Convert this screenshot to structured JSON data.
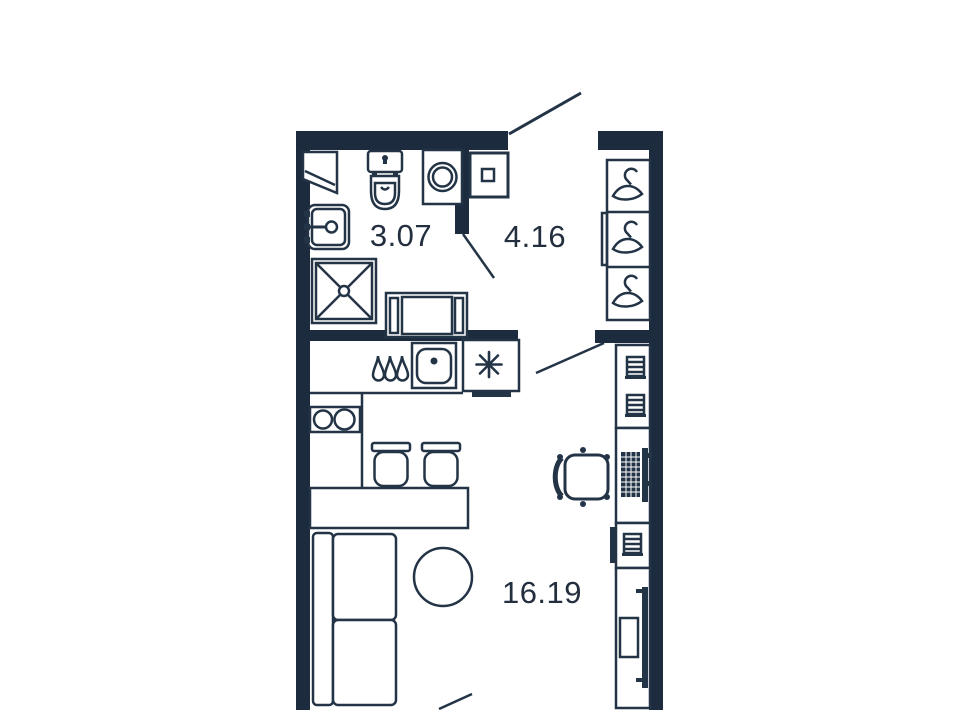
{
  "plan": {
    "type": "studio-apartment-floor-plan",
    "colors": {
      "wall": "#1d2b3f",
      "outline": "#243447",
      "text": "#232e3e",
      "background": "#ffffff"
    },
    "rooms": {
      "bathroom": {
        "label": "3.07",
        "fixtures": [
          "corner-shelf-icon",
          "toilet-icon",
          "washing-machine-icon",
          "wash-basin-icon",
          "shower-icon",
          "vanity-cabinet-icon"
        ]
      },
      "hallway": {
        "label": "4.16",
        "fixtures": [
          "electrical-panel-icon",
          "wardrobe-icon",
          "hanger-icon",
          "hanger-icon",
          "hanger-icon"
        ]
      },
      "living_kitchen": {
        "label": "16.19",
        "fixtures": [
          "water-drops-icon",
          "kitchen-sink-icon",
          "fridge-asterisk-icon",
          "two-burner-hob-icon",
          "stool-icon",
          "stool-icon",
          "kitchen-table-icon",
          "sofa-icon",
          "round-table-icon",
          "drawer-stack-icon",
          "desk-icon",
          "keyboard-icon",
          "monitor-icon",
          "office-chair-icon",
          "tv-icon",
          "tv-stand-icon"
        ]
      }
    },
    "doors": [
      "entrance-door-swing",
      "bathroom-door-swing",
      "room-door-swing",
      "balcony-door-swing"
    ]
  }
}
